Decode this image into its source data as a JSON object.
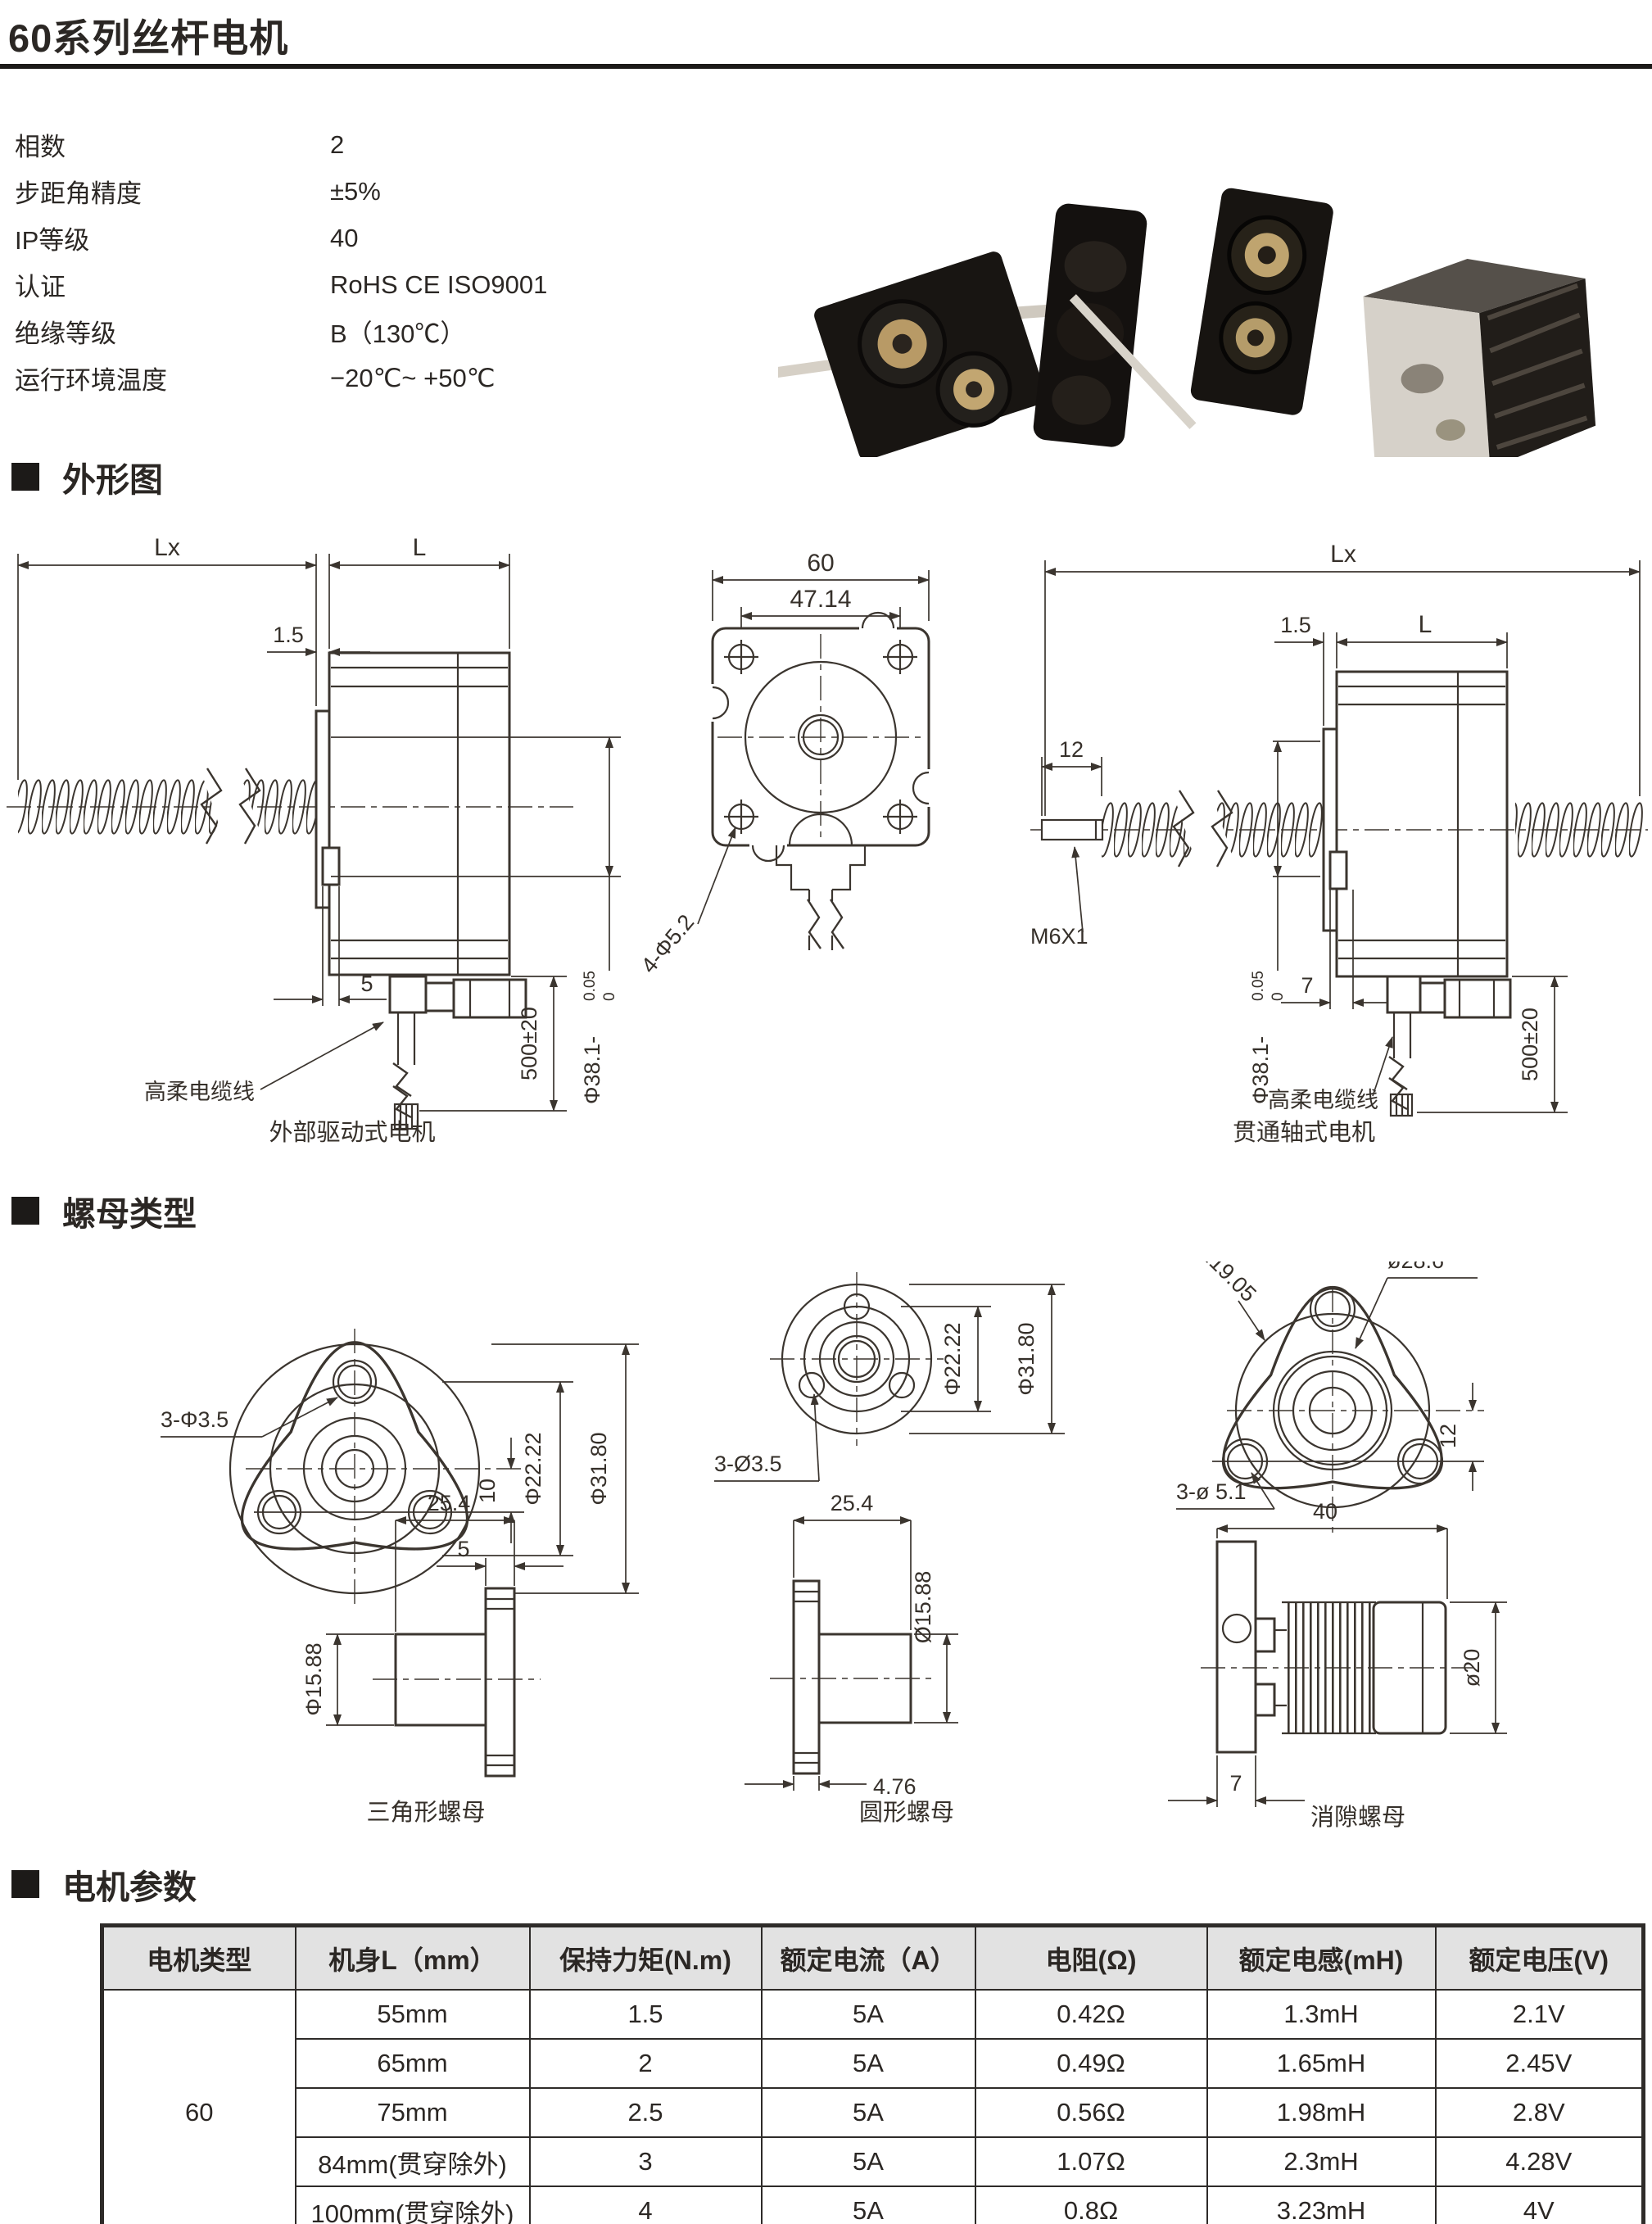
{
  "page": {
    "title": "60系列丝杆电机"
  },
  "specs": [
    {
      "label": "相数",
      "value": "2"
    },
    {
      "label": "步距角精度",
      "value": "±5%"
    },
    {
      "label": "IP等级",
      "value": "40"
    },
    {
      "label": "认证",
      "value": "RoHS CE ISO9001"
    },
    {
      "label": "绝缘等级",
      "value": "B（130℃）"
    },
    {
      "label": "运行环境温度",
      "value": "−20℃~ +50℃"
    }
  ],
  "sections": {
    "outline": "外形图",
    "nuts": "螺母类型",
    "params": "电机参数"
  },
  "outline": {
    "external": {
      "lx": "Lx",
      "l": "L",
      "offset": "1.5",
      "dia": "Φ38.1-",
      "tol_top": "0",
      "tol_bot": "0.05",
      "tab": "5",
      "cable_len": "500±20",
      "cable": "高柔电缆线",
      "caption": "外部驱动式电机"
    },
    "front": {
      "width": "60",
      "inner": "47.14",
      "holes": "4-Φ5.2"
    },
    "through": {
      "lx": "Lx",
      "offset": "1.5",
      "l": "L",
      "stub": "12",
      "thread": "M6X1",
      "tab": "7",
      "dia": "Φ38.1-",
      "tol_top": "0",
      "tol_bot": "0.05",
      "cable_len": "500±20",
      "cable": "高柔电缆线",
      "caption": "贯通轴式电机"
    }
  },
  "nuts": {
    "triangle": {
      "holes": "3-Φ3.5",
      "pitch": "10",
      "bcd": "Φ22.22",
      "od": "Φ31.80",
      "len": "25.4",
      "flange": "5",
      "dia": "Φ15.88",
      "caption": "三角形螺母"
    },
    "round": {
      "bcd": "Φ22.22",
      "od": "Φ31.80",
      "holes": "3-Ø3.5",
      "len": "25.4",
      "dia": "Ø15.88",
      "flange": "4.76",
      "caption": "圆形螺母"
    },
    "backlash": {
      "radius": "R19.05",
      "od": "ø28.6",
      "pitch": "12",
      "holes": "3-ø 5.1",
      "len": "40",
      "dia": "ø20",
      "flange": "7",
      "caption": "消隙螺母"
    }
  },
  "table": {
    "headers": [
      "电机类型",
      "机身L（mm）",
      "保持力矩(N.m)",
      "额定电流（A）",
      "电阻(Ω)",
      "额定电感(mH)",
      "额定电压(V)"
    ],
    "motor_type": "60",
    "rows": [
      {
        "body": "55mm",
        "torque": "1.5",
        "current": "5A",
        "resistance": "0.42Ω",
        "inductance": "1.3mH",
        "voltage": "2.1V"
      },
      {
        "body": "65mm",
        "torque": "2",
        "current": "5A",
        "resistance": "0.49Ω",
        "inductance": "1.65mH",
        "voltage": "2.45V"
      },
      {
        "body": "75mm",
        "torque": "2.5",
        "current": "5A",
        "resistance": "0.56Ω",
        "inductance": "1.98mH",
        "voltage": "2.8V"
      },
      {
        "body": "84mm(贯穿除外)",
        "torque": "3",
        "current": "5A",
        "resistance": "1.07Ω",
        "inductance": "2.3mH",
        "voltage": "4.28V"
      },
      {
        "body": "100mm(贯穿除外)",
        "torque": "4",
        "current": "5A",
        "resistance": "0.8Ω",
        "inductance": "3.23mH",
        "voltage": "4V"
      }
    ]
  }
}
